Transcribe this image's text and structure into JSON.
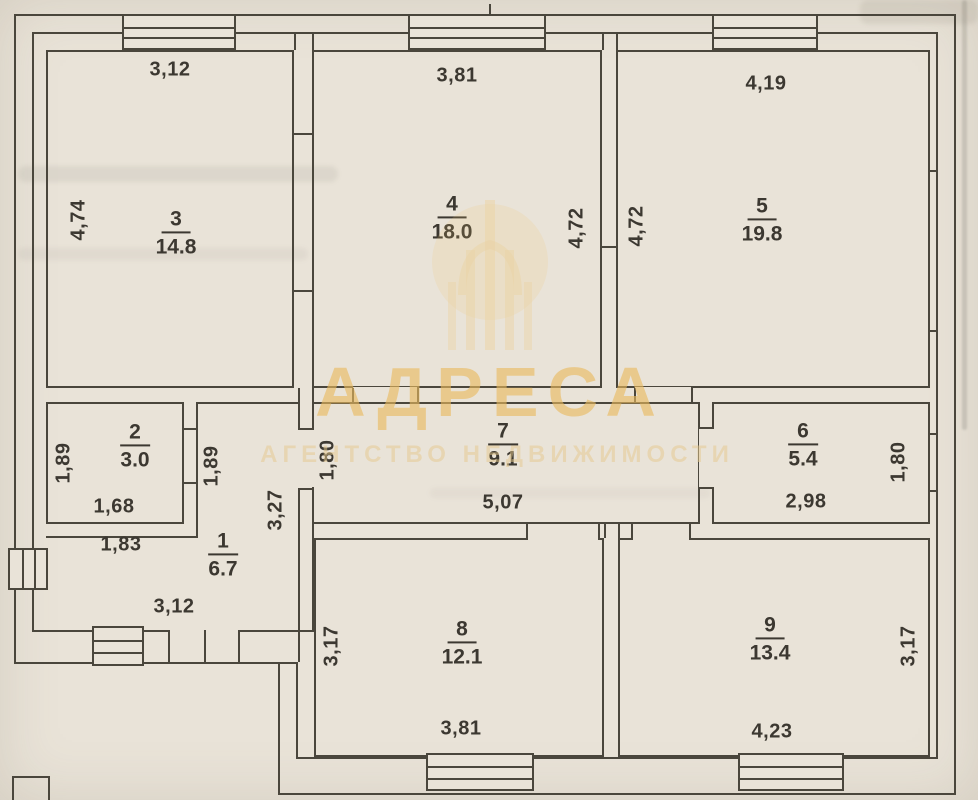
{
  "watermark": {
    "title": "АДРЕСА",
    "subtitle": "АГЕНТСТВО НЕДВИЖИМОСТИ",
    "color": "#eaba5e"
  },
  "rooms": {
    "r1": {
      "number": "1",
      "area": "6.7"
    },
    "r2": {
      "number": "2",
      "area": "3.0"
    },
    "r3": {
      "number": "3",
      "area": "14.8"
    },
    "r4": {
      "number": "4",
      "area": "18.0"
    },
    "r5": {
      "number": "5",
      "area": "19.8"
    },
    "r6": {
      "number": "6",
      "area": "5.4"
    },
    "r7": {
      "number": "7",
      "area": "9.1"
    },
    "r8": {
      "number": "8",
      "area": "12.1"
    },
    "r9": {
      "number": "9",
      "area": "13.4"
    }
  },
  "dims": {
    "room3_top": "3,12",
    "room3_left": "4,74",
    "room4_top": "3,81",
    "room4_right": "4,72",
    "room5_left": "4,72",
    "room5_top": "4,19",
    "room2_left": "1,89",
    "room2_right": "1,89",
    "room2_width": "1,68",
    "room2_outer_width": "1,83",
    "room1_height": "3,27",
    "room1_width": "3,12",
    "room7_left": "1,80",
    "room7_width": "5,07",
    "room6_width": "2,98",
    "room6_right": "1,80",
    "room8_left": "3,17",
    "room8_width": "3,81",
    "room9_width": "4,23",
    "room9_right": "3,17"
  }
}
